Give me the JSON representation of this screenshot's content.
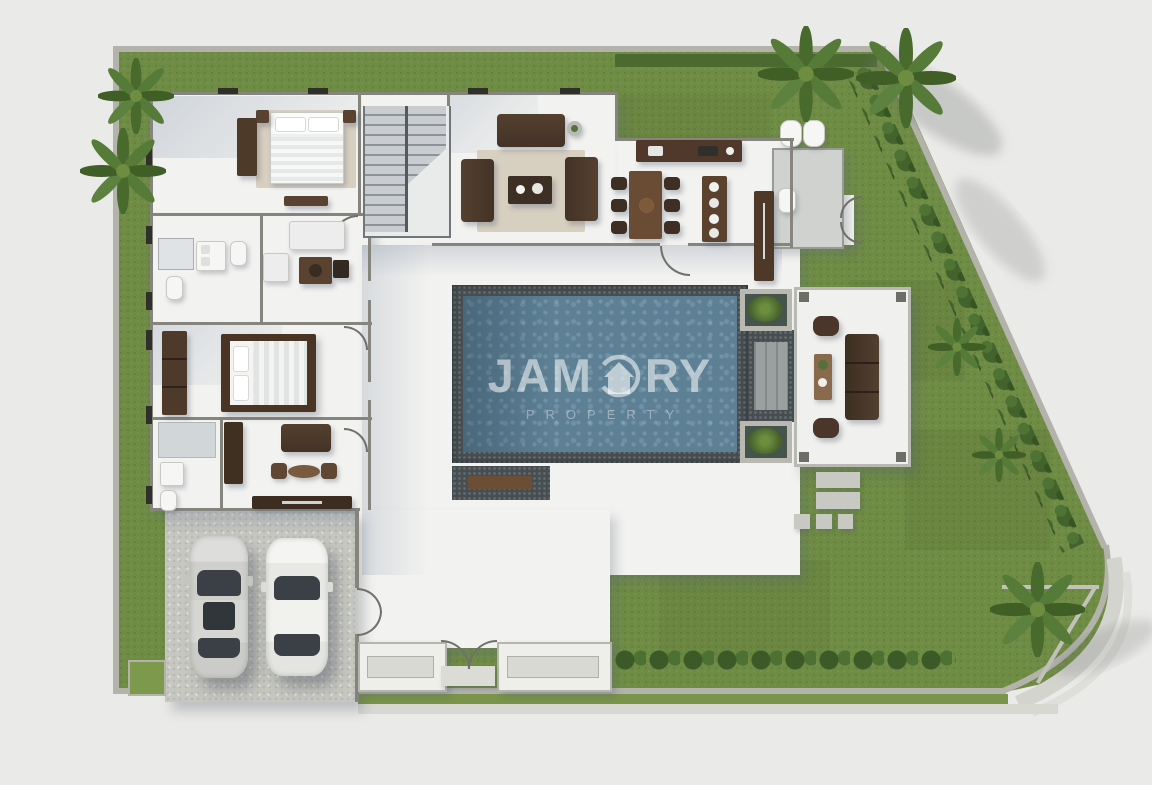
{
  "watermark": {
    "brand": "JAMORY",
    "brand_left": "JAM",
    "brand_right": "RY",
    "subtitle": "PROPERTY",
    "icon": "house-in-circle-icon"
  },
  "palette": {
    "background": "#eaeae8",
    "grass": "#6f8c44",
    "grass_dark": "#5c7836",
    "hedge": "#42632c",
    "boundary_wall": "#b3b3ac",
    "interior_wall": "#85857e",
    "floor_white": "#f2f2f0",
    "concrete": "#c7c7c1",
    "pool_water": "#5d8095",
    "pool_border": "#474e51",
    "wood_dark": "#5a4231",
    "sofa_brown": "#4a362a",
    "rug_beige": "#d7cfc0",
    "car_silver": "#d9d9d6",
    "watermark_text": "rgba(255,255,255,0.55)"
  },
  "scene": {
    "type": "villa-floor-plan-top-view",
    "areas": [
      {
        "name": "bedroom-1",
        "objects": [
          "double-bed",
          "nightstands",
          "wardrobe",
          "console"
        ]
      },
      {
        "name": "staircase",
        "objects": [
          "two-flights"
        ]
      },
      {
        "name": "living-room",
        "objects": [
          "three-sofas",
          "coffee-table",
          "rug",
          "side-table"
        ]
      },
      {
        "name": "kitchen-dining",
        "objects": [
          "kitchen-counter",
          "dining-table",
          "six-chairs",
          "island",
          "pantry-counter"
        ]
      },
      {
        "name": "outdoor-bathroom",
        "objects": [
          "toilet",
          "water-heaters"
        ]
      },
      {
        "name": "bathroom-1",
        "objects": [
          "double-sink",
          "toilets",
          "shower"
        ]
      },
      {
        "name": "study-lounge",
        "objects": [
          "white-sofa",
          "armchair",
          "desk",
          "chair"
        ]
      },
      {
        "name": "master-bedroom",
        "objects": [
          "king-bed",
          "wardrobe-column"
        ]
      },
      {
        "name": "tv-lounge",
        "objects": [
          "sofa",
          "stools",
          "oval-table",
          "tv-console",
          "wardrobe"
        ]
      },
      {
        "name": "bathroom-2",
        "objects": [
          "shower",
          "sink",
          "toilet"
        ]
      },
      {
        "name": "pool-deck",
        "objects": [
          "swimming-pool",
          "planters",
          "pool-steps",
          "bench"
        ]
      },
      {
        "name": "pavilion",
        "objects": [
          "l-sofa",
          "armchairs",
          "coffee-table",
          "stepping-stones"
        ]
      },
      {
        "name": "carport",
        "objects": [
          "silver-car",
          "white-car",
          "gate"
        ]
      },
      {
        "name": "entry",
        "objects": [
          "double-door",
          "planter-walls"
        ]
      },
      {
        "name": "garden",
        "objects": [
          "lawn",
          "hedge-rows",
          "palm-trees",
          "boundary-wall",
          "sidewalk"
        ]
      }
    ]
  }
}
